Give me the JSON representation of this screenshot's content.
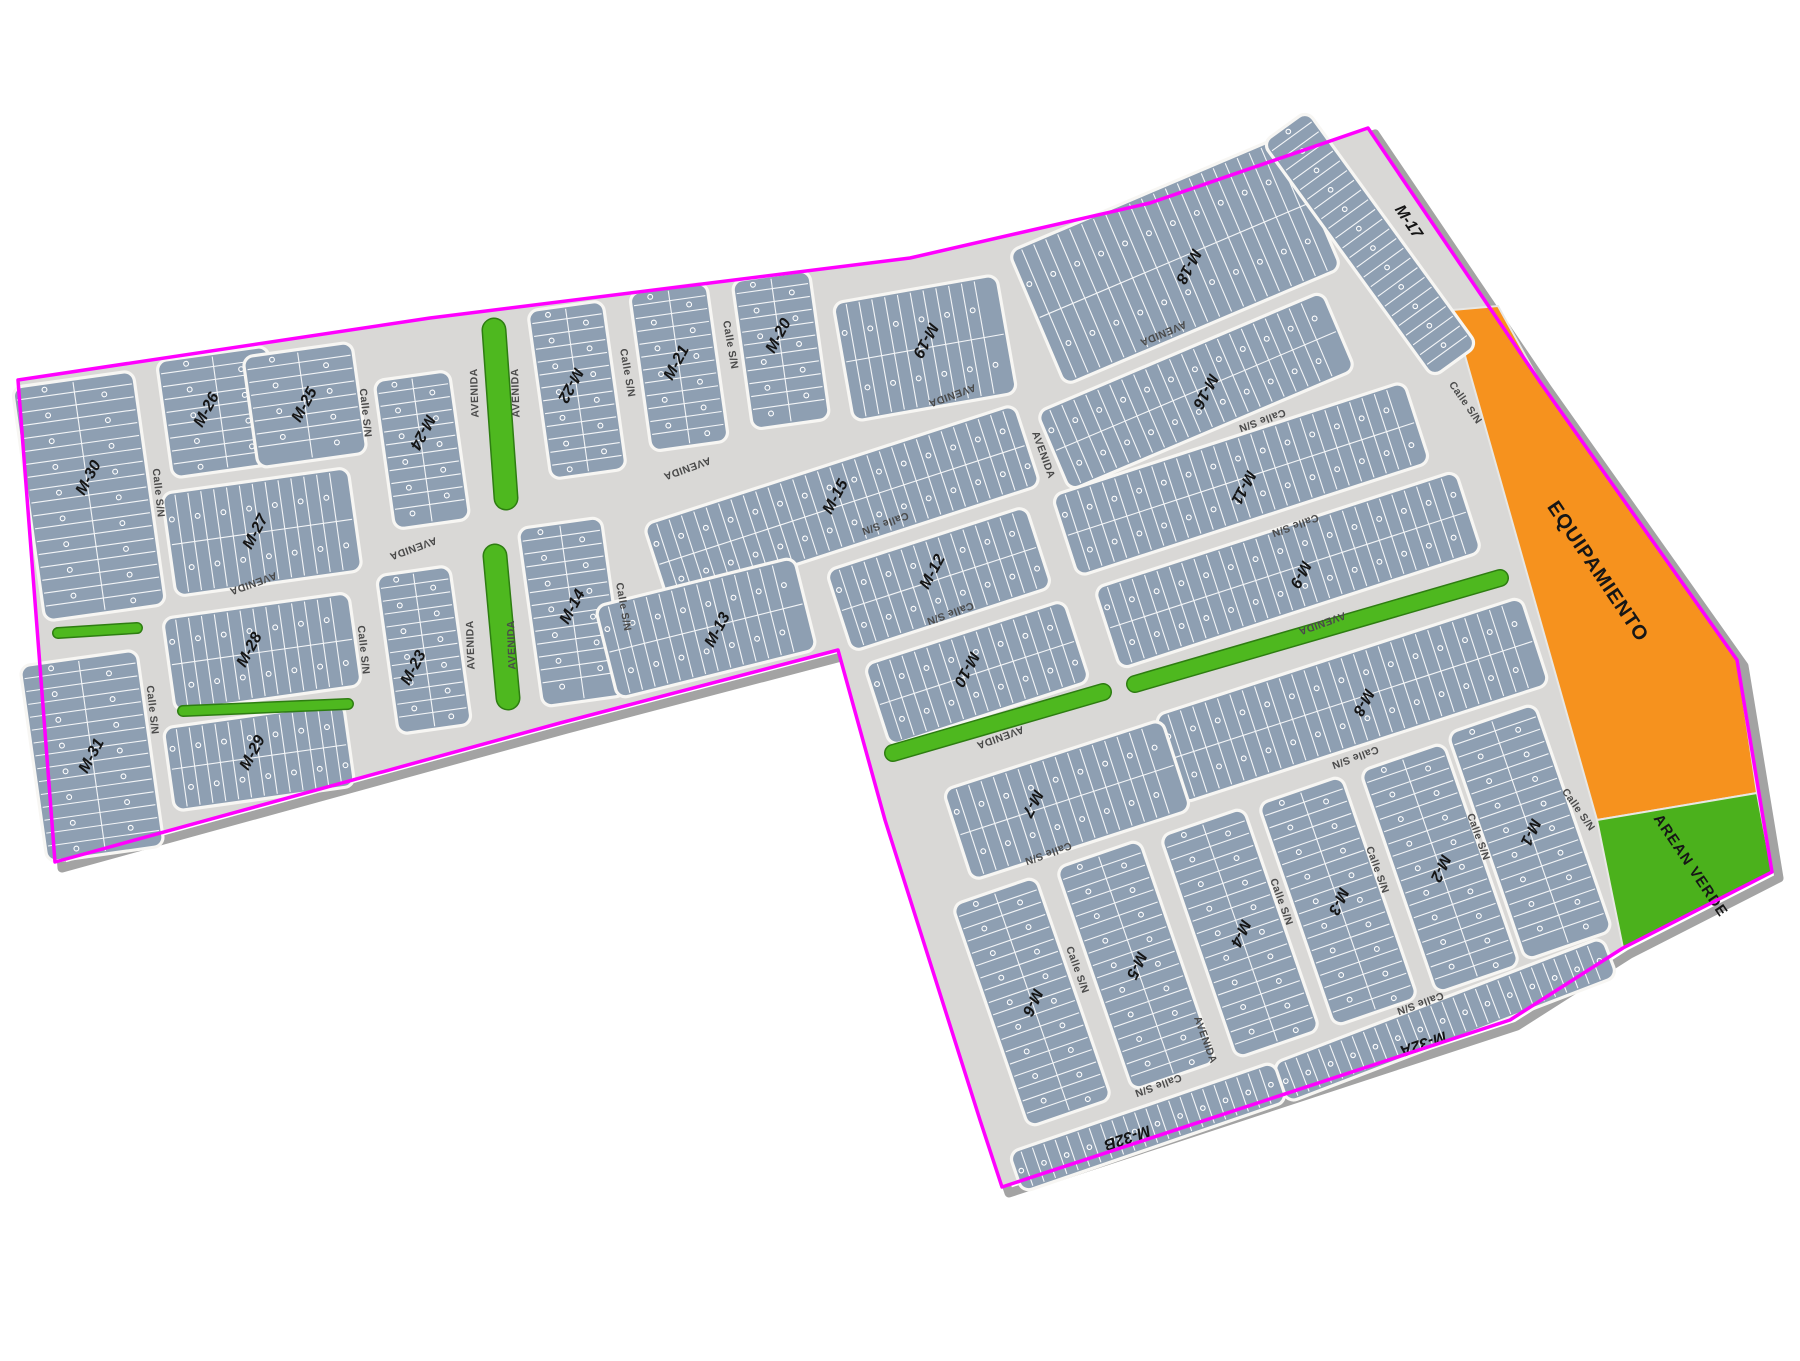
{
  "map": {
    "colors": {
      "background": "#ffffff",
      "street": "#d9d8d6",
      "block_fill": "#8e9fb2",
      "block_stroke": "#f7f6f3",
      "lot_line": "#ffffff",
      "boundary": "#ff00ff",
      "boundary_shadow": "#a3a3a3",
      "median_green": "#4eb81f",
      "median_edge": "#2e7d12",
      "equipamiento_orange": "#f6921e",
      "area_verde_green": "#4bb11c",
      "block_label": "#141414",
      "street_label": "#4a4a4a"
    },
    "boundary": [
      [
        18,
        380
      ],
      [
        430,
        318
      ],
      [
        910,
        258
      ],
      [
        1150,
        203
      ],
      [
        1368,
        128
      ],
      [
        1540,
        382
      ],
      [
        1737,
        660
      ],
      [
        1772,
        872
      ],
      [
        1623,
        948
      ],
      [
        1510,
        1020
      ],
      [
        1002,
        1187
      ],
      [
        980,
        1120
      ],
      [
        885,
        820
      ],
      [
        838,
        650
      ],
      [
        560,
        723
      ],
      [
        55,
        862
      ]
    ],
    "areas": [
      {
        "name": "equipamiento",
        "label": "EQUIPAMIENTO",
        "color": "#f6921e",
        "points": [
          [
            1452,
            310
          ],
          [
            1498,
            306
          ],
          [
            1540,
            382
          ],
          [
            1737,
            660
          ],
          [
            1757,
            793
          ],
          [
            1597,
            820
          ]
        ],
        "label_x": 1597,
        "label_y": 572,
        "label_rot": 56,
        "label_size": 20
      },
      {
        "name": "area-verde",
        "label": "AREAN VERDE",
        "color": "#4bb11c",
        "points": [
          [
            1597,
            820
          ],
          [
            1757,
            793
          ],
          [
            1772,
            872
          ],
          [
            1623,
            948
          ]
        ],
        "label_x": 1690,
        "label_y": 866,
        "label_rot": 56,
        "label_size": 15
      }
    ],
    "blocks": [
      {
        "name": "M-30",
        "cx": 89,
        "cy": 496,
        "w": 122,
        "h": 236,
        "rot": -8,
        "lrot": -62,
        "rows": 2,
        "lx": 89,
        "ly": 478
      },
      {
        "name": "M-31",
        "cx": 92,
        "cy": 756,
        "w": 118,
        "h": 198,
        "rot": -8,
        "lrot": -62,
        "rows": 2
      },
      {
        "name": "M-26",
        "cx": 220,
        "cy": 412,
        "w": 112,
        "h": 118,
        "rot": -8,
        "lrot": -62,
        "rows": 2,
        "lx": 207,
        "ly": 410
      },
      {
        "name": "M-25",
        "cx": 305,
        "cy": 405,
        "w": 110,
        "h": 112,
        "rot": -8,
        "lrot": -62,
        "rows": 2
      },
      {
        "name": "M-24",
        "cx": 422,
        "cy": 450,
        "w": 76,
        "h": 150,
        "rot": -8,
        "lrot": 118,
        "rows": 2,
        "lx": 422,
        "ly": 432
      },
      {
        "name": "M-23",
        "cx": 424,
        "cy": 650,
        "w": 74,
        "h": 160,
        "rot": -8,
        "lrot": -62,
        "rows": 2,
        "lx": 414,
        "ly": 668
      },
      {
        "name": "M-27",
        "cx": 262,
        "cy": 532,
        "w": 188,
        "h": 104,
        "rot": -8,
        "lrot": -62,
        "rows": 2,
        "lx": 256,
        "ly": 532
      },
      {
        "name": "M-28",
        "cx": 262,
        "cy": 652,
        "w": 188,
        "h": 94,
        "rot": -8,
        "lrot": -62,
        "rows": 2,
        "lx": 250,
        "ly": 650
      },
      {
        "name": "M-29",
        "cx": 259,
        "cy": 757,
        "w": 182,
        "h": 84,
        "rot": -8,
        "lrot": -62,
        "rows": 2,
        "lx": 253,
        "ly": 753
      },
      {
        "name": "M-22",
        "cx": 577,
        "cy": 390,
        "w": 76,
        "h": 170,
        "rot": -8,
        "lrot": 118,
        "rows": 2,
        "lx": 570,
        "ly": 385
      },
      {
        "name": "M-21",
        "cx": 679,
        "cy": 367,
        "w": 78,
        "h": 160,
        "rot": -8,
        "lrot": -62,
        "rows": 2,
        "lx": 677,
        "ly": 363
      },
      {
        "name": "M-20",
        "cx": 781,
        "cy": 350,
        "w": 78,
        "h": 150,
        "rot": -8,
        "lrot": -62,
        "rows": 2,
        "lx": 779,
        "ly": 336
      },
      {
        "name": "M-19",
        "cx": 925,
        "cy": 348,
        "w": 166,
        "h": 120,
        "rot": -10,
        "lrot": 118,
        "rows": 2,
        "lx": 925,
        "ly": 340
      },
      {
        "name": "M-18",
        "cx": 1175,
        "cy": 260,
        "w": 300,
        "h": 145,
        "rot": -23,
        "lrot": 118,
        "rows": 2,
        "lx": 1188,
        "ly": 266
      },
      {
        "name": "M-17",
        "cx": 1370,
        "cy": 244,
        "w": 290,
        "h": 55,
        "rot": 54,
        "lrot": 56,
        "rows": 1,
        "lx": 1408,
        "ly": 222
      },
      {
        "name": "M-16",
        "cx": 1196,
        "cy": 391,
        "w": 310,
        "h": 85,
        "rot": -23,
        "lrot": 118,
        "rows": 2,
        "lx": 1205,
        "ly": 391
      },
      {
        "name": "M-15",
        "cx": 842,
        "cy": 505,
        "w": 390,
        "h": 85,
        "rot": -18,
        "lrot": -62,
        "rows": 2,
        "lx": 836,
        "ly": 497
      },
      {
        "name": "M-14",
        "cx": 572,
        "cy": 612,
        "w": 84,
        "h": 180,
        "rot": -8,
        "lrot": -62,
        "rows": 2,
        "lx": 573,
        "ly": 607
      },
      {
        "name": "M-13",
        "cx": 706,
        "cy": 628,
        "w": 205,
        "h": 95,
        "rot": -14,
        "lrot": -62,
        "rows": 2,
        "lx": 718,
        "ly": 630
      },
      {
        "name": "M-12",
        "cx": 939,
        "cy": 579,
        "w": 210,
        "h": 85,
        "rot": -18,
        "lrot": -62,
        "rows": 2,
        "lx": 933,
        "ly": 572
      },
      {
        "name": "M-11",
        "cx": 1241,
        "cy": 479,
        "w": 370,
        "h": 85,
        "rot": -18,
        "lrot": 118,
        "rows": 2,
        "lx": 1243,
        "ly": 487
      },
      {
        "name": "M-10",
        "cx": 977,
        "cy": 673,
        "w": 210,
        "h": 85,
        "rot": -18,
        "lrot": 118,
        "rows": 2,
        "lx": 966,
        "ly": 669
      },
      {
        "name": "M-9",
        "cx": 1288,
        "cy": 570,
        "w": 380,
        "h": 85,
        "rot": -18,
        "lrot": 118,
        "rows": 2,
        "lx": 1300,
        "ly": 574
      },
      {
        "name": "M-8",
        "cx": 1352,
        "cy": 700,
        "w": 385,
        "h": 92,
        "rot": -18,
        "lrot": 118,
        "rows": 2,
        "lx": 1363,
        "ly": 702
      },
      {
        "name": "M-7",
        "cx": 1067,
        "cy": 800,
        "w": 230,
        "h": 95,
        "rot": -18,
        "lrot": 118,
        "rows": 2,
        "lx": 1032,
        "ly": 803
      },
      {
        "name": "M-6",
        "cx": 1032,
        "cy": 1002,
        "w": 88,
        "h": 235,
        "rot": -19,
        "lrot": 115,
        "rows": 2
      },
      {
        "name": "M-5",
        "cx": 1136,
        "cy": 965,
        "w": 88,
        "h": 235,
        "rot": -19,
        "lrot": 115,
        "rows": 2
      },
      {
        "name": "M-4",
        "cx": 1240,
        "cy": 933,
        "w": 88,
        "h": 235,
        "rot": -19,
        "lrot": 115,
        "rows": 2
      },
      {
        "name": "M-3",
        "cx": 1338,
        "cy": 901,
        "w": 88,
        "h": 235,
        "rot": -19,
        "lrot": 115,
        "rows": 2
      },
      {
        "name": "M-2",
        "cx": 1440,
        "cy": 868,
        "w": 88,
        "h": 235,
        "rot": -19,
        "lrot": 115,
        "rows": 2
      },
      {
        "name": "M-1",
        "cx": 1530,
        "cy": 832,
        "w": 92,
        "h": 240,
        "rot": -19,
        "lrot": 115,
        "rows": 2
      },
      {
        "name": "M-32A",
        "cx": 1445,
        "cy": 1020,
        "w": 353,
        "h": 42,
        "rot": -21,
        "lrot": 161,
        "rows": 1,
        "lx": 1423,
        "ly": 1043
      },
      {
        "name": "M-32B",
        "cx": 1148,
        "cy": 1127,
        "w": 280,
        "h": 42,
        "rot": -19,
        "lrot": 161,
        "rows": 1,
        "lx": 1127,
        "ly": 1137
      }
    ],
    "medians": [
      {
        "x1": 494,
        "y1": 330,
        "x2": 506,
        "y2": 498,
        "w": 22
      },
      {
        "x1": 495,
        "y1": 556,
        "x2": 508,
        "y2": 698,
        "w": 22
      },
      {
        "x1": 58,
        "y1": 633,
        "x2": 137,
        "y2": 628,
        "w": 9
      },
      {
        "x1": 183,
        "y1": 711,
        "x2": 348,
        "y2": 704,
        "w": 9
      },
      {
        "x1": 893,
        "y1": 753,
        "x2": 1103,
        "y2": 692,
        "w": 15
      },
      {
        "x1": 1135,
        "y1": 684,
        "x2": 1500,
        "y2": 578,
        "w": 15
      }
    ],
    "street_labels": [
      {
        "text": "Calle S/N",
        "x": 158,
        "y": 493,
        "rot": 84
      },
      {
        "text": "Calle S/N",
        "x": 365,
        "y": 413,
        "rot": 84
      },
      {
        "text": "Calle S/N",
        "x": 363,
        "y": 650,
        "rot": 84
      },
      {
        "text": "Calle S/N",
        "x": 152,
        "y": 710,
        "rot": 84
      },
      {
        "text": "Calle S/N",
        "x": 627,
        "y": 373,
        "rot": 80
      },
      {
        "text": "Calle S/N",
        "x": 730,
        "y": 345,
        "rot": 80
      },
      {
        "text": "Calle S/N",
        "x": 623,
        "y": 607,
        "rot": 80
      },
      {
        "text": "Calle S/N",
        "x": 885,
        "y": 523,
        "rot": 160
      },
      {
        "text": "Calle S/N",
        "x": 950,
        "y": 613,
        "rot": 160
      },
      {
        "text": "Calle S/N",
        "x": 1262,
        "y": 420,
        "rot": 160
      },
      {
        "text": "Calle S/N",
        "x": 1295,
        "y": 525,
        "rot": 160
      },
      {
        "text": "Calle S/N",
        "x": 1048,
        "y": 853,
        "rot": 160
      },
      {
        "text": "Calle S/N",
        "x": 1158,
        "y": 1085,
        "rot": 160
      },
      {
        "text": "Calle S/N",
        "x": 1355,
        "y": 757,
        "rot": 160
      },
      {
        "text": "Calle S/N",
        "x": 1420,
        "y": 1003,
        "rot": 160
      },
      {
        "text": "Calle S/N",
        "x": 1077,
        "y": 970,
        "rot": 70
      },
      {
        "text": "Calle S/N",
        "x": 1281,
        "y": 902,
        "rot": 70
      },
      {
        "text": "Calle S/N",
        "x": 1377,
        "y": 870,
        "rot": 70
      },
      {
        "text": "Calle S/N",
        "x": 1478,
        "y": 837,
        "rot": 70
      },
      {
        "text": "Calle S/N",
        "x": 1465,
        "y": 403,
        "rot": 55
      },
      {
        "text": "Calle S/N",
        "x": 1578,
        "y": 810,
        "rot": 55
      },
      {
        "text": "AVENIDA",
        "x": 475,
        "y": 393,
        "rot": -92
      },
      {
        "text": "AVENIDA",
        "x": 516,
        "y": 393,
        "rot": -92
      },
      {
        "text": "AVENIDA",
        "x": 471,
        "y": 645,
        "rot": -92
      },
      {
        "text": "AVENIDA",
        "x": 512,
        "y": 645,
        "rot": -92
      },
      {
        "text": "AVENIDA",
        "x": 253,
        "y": 583,
        "rot": 160
      },
      {
        "text": "AVENIDA",
        "x": 413,
        "y": 548,
        "rot": 160
      },
      {
        "text": "AVENIDA",
        "x": 687,
        "y": 468,
        "rot": 160
      },
      {
        "text": "AVENIDA",
        "x": 952,
        "y": 395,
        "rot": 160
      },
      {
        "text": "AVENIDA",
        "x": 1163,
        "y": 333,
        "rot": 157
      },
      {
        "text": "AVENIDA",
        "x": 1322,
        "y": 623,
        "rot": 160
      },
      {
        "text": "AVENIDA",
        "x": 1000,
        "y": 737,
        "rot": 160
      },
      {
        "text": "AVENIDA",
        "x": 1043,
        "y": 455,
        "rot": 70
      },
      {
        "text": "AVENIDA",
        "x": 1205,
        "y": 1040,
        "rot": 70
      }
    ]
  }
}
